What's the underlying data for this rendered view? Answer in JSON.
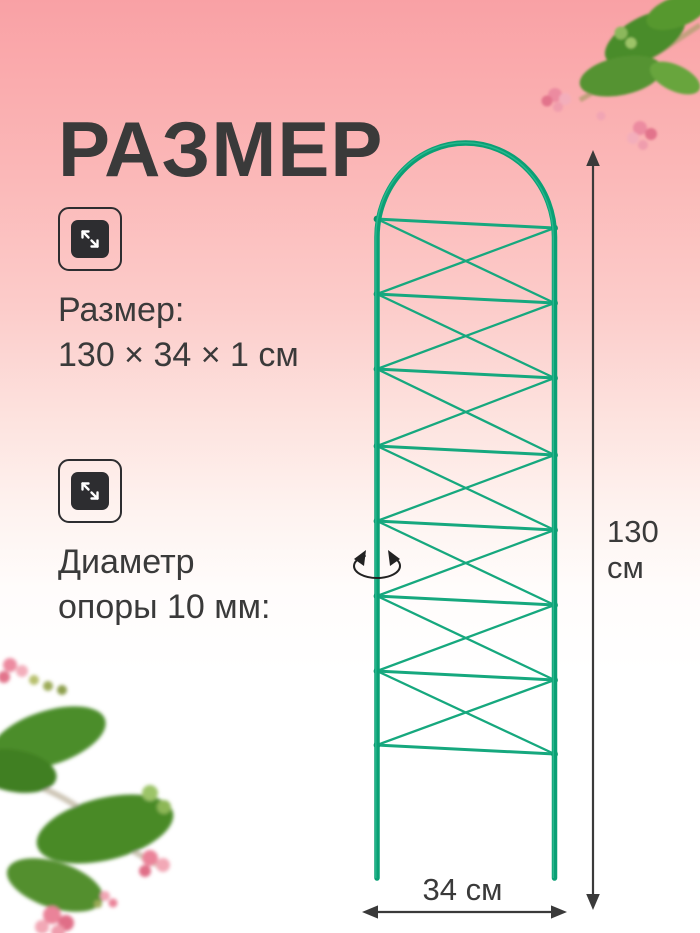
{
  "header": {
    "title": "РАЗМЕР"
  },
  "features": [
    {
      "icon": "expand-size-icon",
      "lines": [
        "Размер:",
        "130 × 34 × 1 см"
      ]
    },
    {
      "icon": "expand-size-icon",
      "lines": [
        "Диаметр",
        "опоры 10 мм:"
      ]
    }
  ],
  "dimensions": {
    "height_label": "130 см",
    "width_label": "34 см"
  },
  "colors": {
    "background_top": "#f9a1a5",
    "background_bottom": "#ffffff",
    "trellis_frame": "#0aa075",
    "trellis_wire": "#16a87e",
    "text": "#3a3a3a",
    "dimension_arrow": "#3a3a3a",
    "flower_pink": "#ec8ba0",
    "leaf_green": "#4c8d2a"
  }
}
